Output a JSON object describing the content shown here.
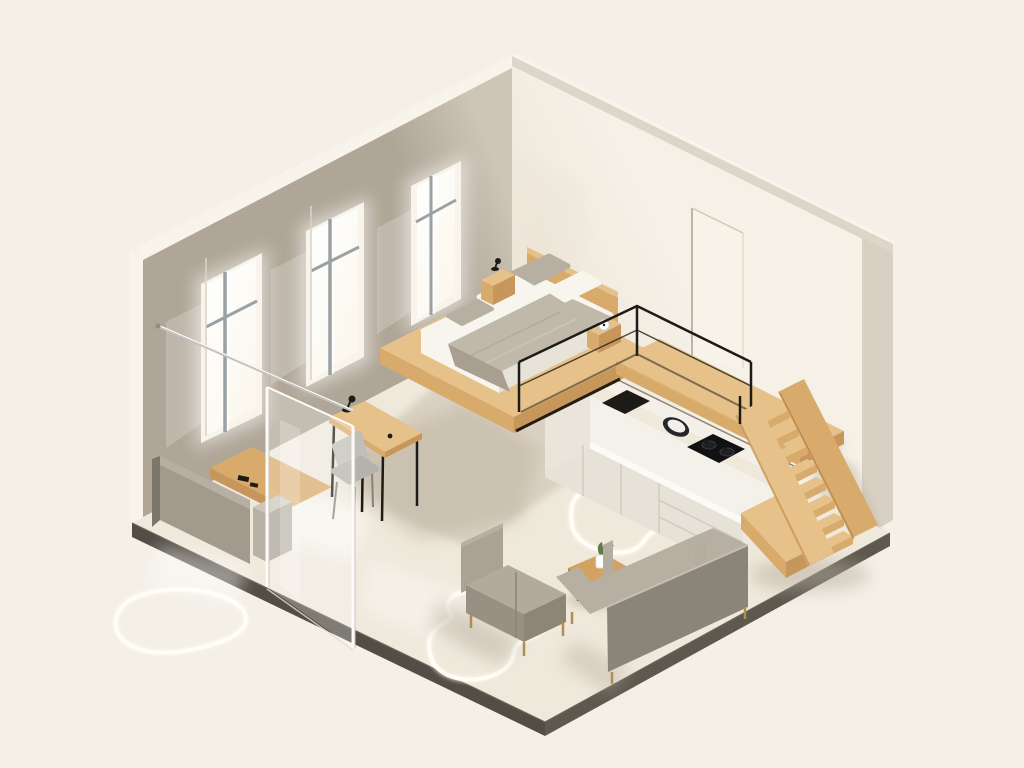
{
  "scene": {
    "title": "Isometric 3D illustration of a minimalist studio loft apartment",
    "aria_label": "Isometric studio apartment illustration: taupe wall with three windows, cream wall with door outline, loft bed on a wooden platform above a white kitchen counter, wooden open stairs, glass partition with desk and chair, entry bench with console, gray armchair, wooden coffee table with plant, gray sofa, and glowing freeform light strips on the floor",
    "background": "#f4f0e8"
  },
  "palette": {
    "bg": "#f4f0e8",
    "wallTaupe": "#b0a697",
    "wallTaupeLight": "#cdc5b6",
    "wallTopBand": "#f8f4eb",
    "topBandShade": "#ddd6c8",
    "wallCream": "#f6f1e7",
    "wallCreamShade": "#ebe4d6",
    "wallEdge": "#d8d1c3",
    "floor": "#efe9dc",
    "floorShade": "#d3c9ba",
    "floorShadow": "#bdb2a0",
    "slabEdge": "#534e45",
    "slabEdge2": "#5e584e",
    "woodTop": "#e6c28a",
    "woodMid": "#d8aa6c",
    "woodDark": "#c6965a",
    "woodDeep": "#a97f42",
    "white": "#f8f5ef",
    "mattressShade": "#e7e3d8",
    "blanket": "#c0b8a9",
    "blanketDark": "#a99f90",
    "pillowTaupe": "#b7afa1",
    "grayLight": "#b6afa2",
    "gray": "#a29b8d",
    "grayDark": "#8b8478",
    "grayDeep": "#7c766a",
    "chairGray": "#c0beb8",
    "counterFace": "#e6e2d8",
    "counterSeam": "#d1ccc1",
    "counterTop": "#f4f1ea",
    "black": "#1d1b18",
    "metal": "#c2c1bd",
    "muntin": "#9aa1a5",
    "windowPane": "#fffef9",
    "glow": "#fffdf4",
    "green": "#5f7c4c",
    "brass": "#b08d55"
  },
  "objects": [
    {
      "name": "left-wall",
      "description": "taupe wall with three tall white-framed windows"
    },
    {
      "name": "right-wall",
      "description": "cream wall with recessed door outline"
    },
    {
      "name": "floor-slab",
      "description": "cream floor with dark front edges"
    },
    {
      "name": "glass-partition",
      "description": "frameless glass panel with metal support rod"
    },
    {
      "name": "entry-bench",
      "description": "gray bench backed by wooden console table and gray side cabinet"
    },
    {
      "name": "desk",
      "description": "wooden desk with black legs, small black lamp and gray chair"
    },
    {
      "name": "loft-platform",
      "description": "cantilevered wooden sleeping platform and walkway"
    },
    {
      "name": "bed",
      "description": "double bed with white linen, taupe throw, four pillows, headboard, two nightstands, lamp and clock"
    },
    {
      "name": "loft-railing",
      "description": "thin black metal railing on the walkway"
    },
    {
      "name": "kitchen-counter",
      "description": "white counter with induction cooktop, round sink and two-burner hob"
    },
    {
      "name": "stairs",
      "description": "wooden open-riser staircase with eight steps"
    },
    {
      "name": "living-area",
      "description": "gray armchair, wooden coffee table with potted plant, gray sofa"
    },
    {
      "name": "floor-lights",
      "description": "glowing freeform LED loops embedded in the floor"
    }
  ],
  "counts": {
    "windows": 3,
    "stair_steps": 8,
    "pillows": 4,
    "floor_light_loops": 3,
    "nightstands": 2
  }
}
